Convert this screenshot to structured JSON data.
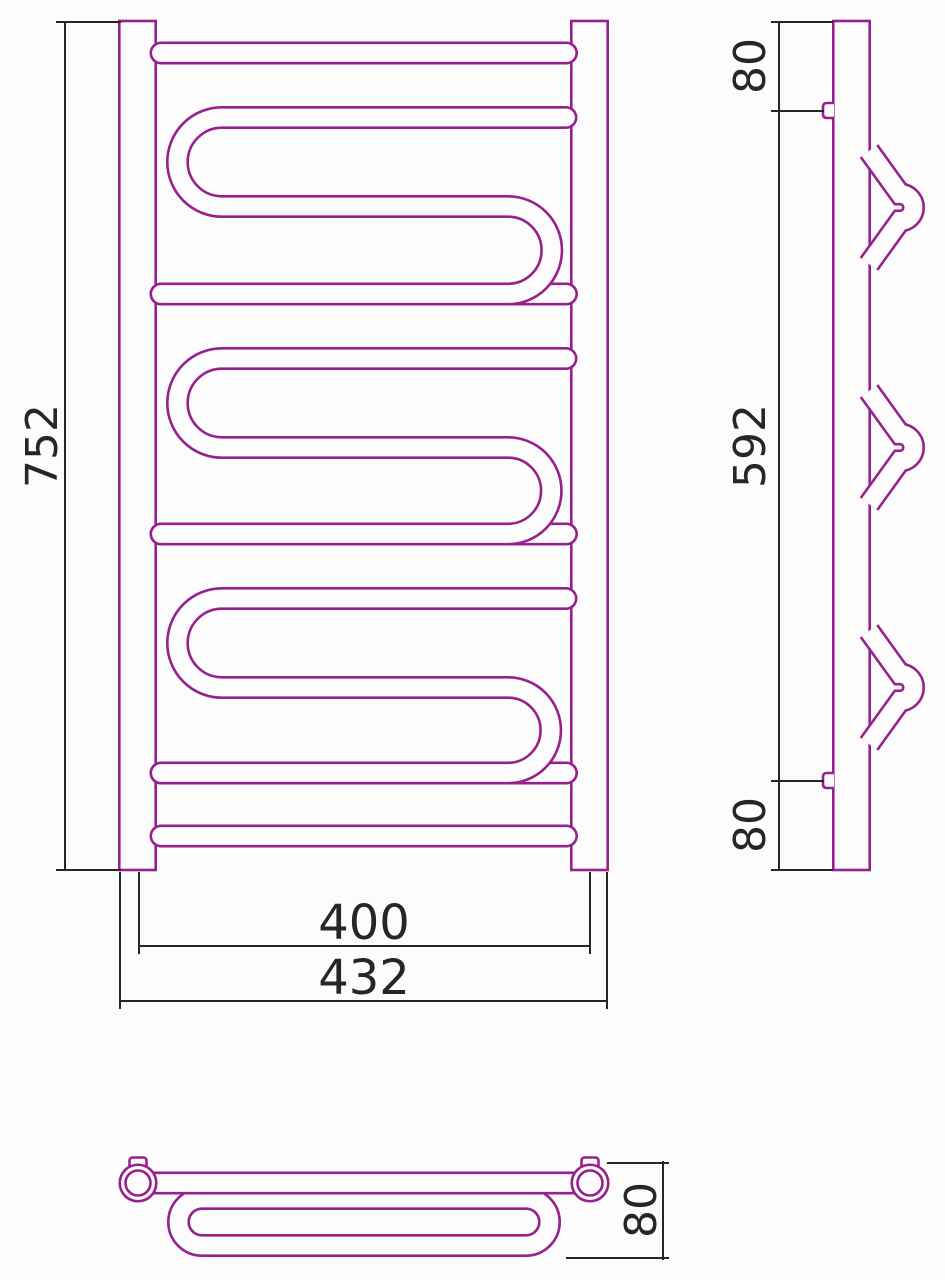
{
  "drawing": {
    "kind": "heated-towel-rail-three-view-technical-drawing",
    "views": {
      "front": {
        "label": "front-view",
        "dims": {
          "height": "752",
          "rail_center_width": "400",
          "overall_width": "432"
        }
      },
      "side": {
        "label": "side-view",
        "dims": {
          "top_offset": "80",
          "bracket_span": "592",
          "bottom_offset": "80"
        }
      },
      "top": {
        "label": "top-view",
        "dims": {
          "depth": "80"
        }
      }
    },
    "colors": {
      "outline": "#97208c",
      "dimension_lines": "#262626",
      "background": "#fcfcfc"
    }
  }
}
